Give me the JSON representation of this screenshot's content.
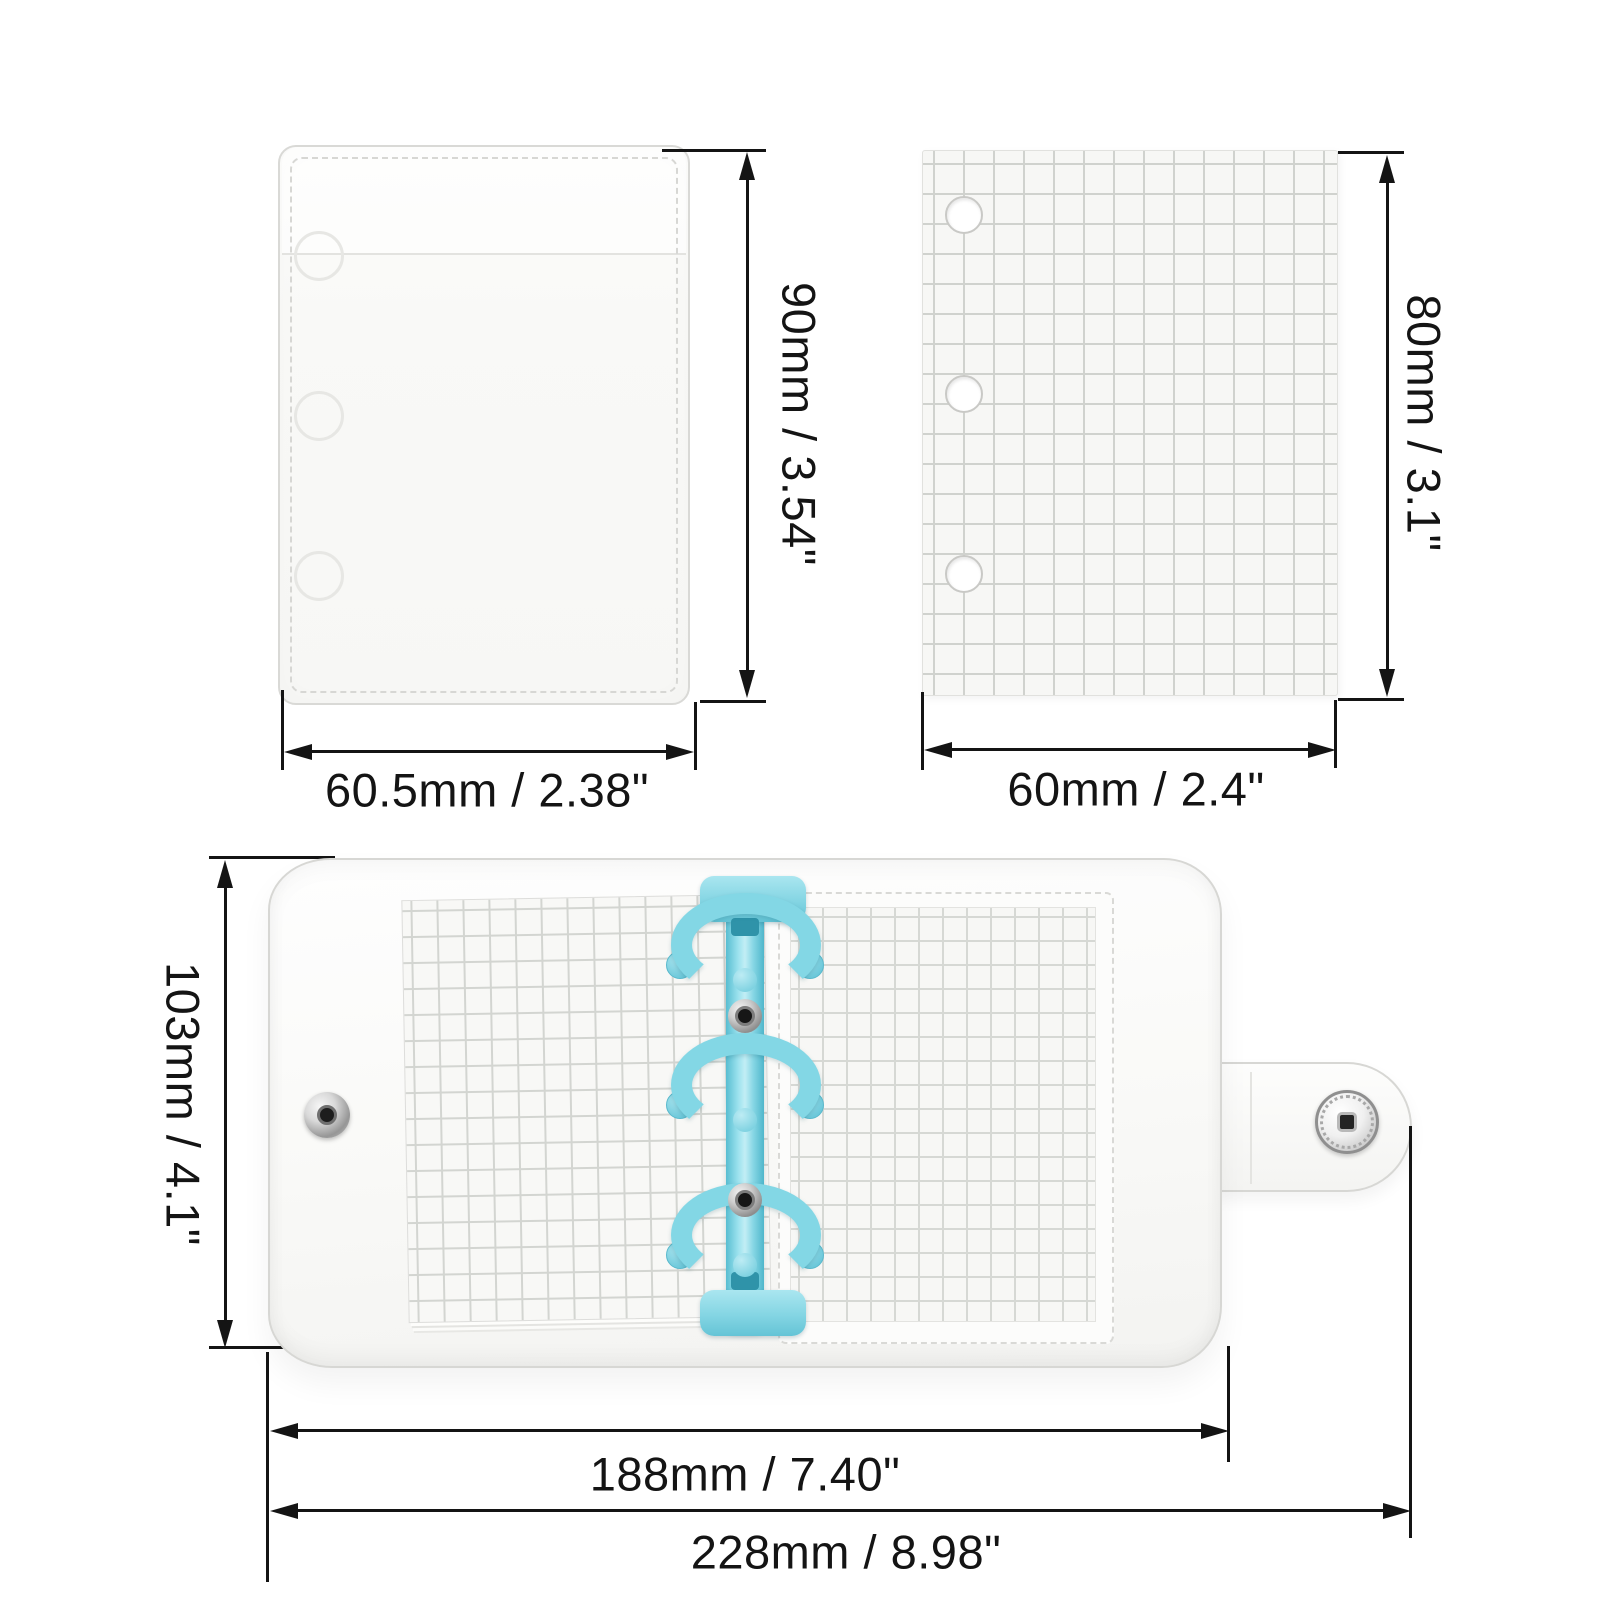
{
  "page": {
    "type": "product-dimension-diagram",
    "background": "#ffffff",
    "description": "Three-view spec diagram of a mini transparent 3-ring binder: clear PVC pocket sleeve, grid refill paper, and the open binder with blue ring mechanism"
  },
  "colors": {
    "dimension_line": "#141414",
    "ring_blue": "#83d7e5",
    "spine_blue_dark": "#4fb6cb",
    "paper_grid_line": "#d0d2ce",
    "paper_background": "#f7f7f5",
    "pvc_edge": "#d7d7d4",
    "snap_metal": "#c9c9c9"
  },
  "figures": {
    "pocket": {
      "name": "clear binder pocket sleeve",
      "hole_count": 3,
      "height_label": "90mm / 3.54\"",
      "width_label": "60.5mm / 2.38\""
    },
    "grid_paper": {
      "name": "grid refill paper",
      "hole_count": 3,
      "height_label": "80mm / 3.1\"",
      "width_label": "60mm / 2.4\""
    },
    "open_binder": {
      "name": "open 3-ring mini binder",
      "ring_count": 3,
      "rivet_count": 2,
      "snap_count": 2,
      "height_label": "103mm / 4.1\"",
      "inner_width_label": "188mm / 7.40\"",
      "outer_width_label": "228mm / 8.98\""
    }
  }
}
